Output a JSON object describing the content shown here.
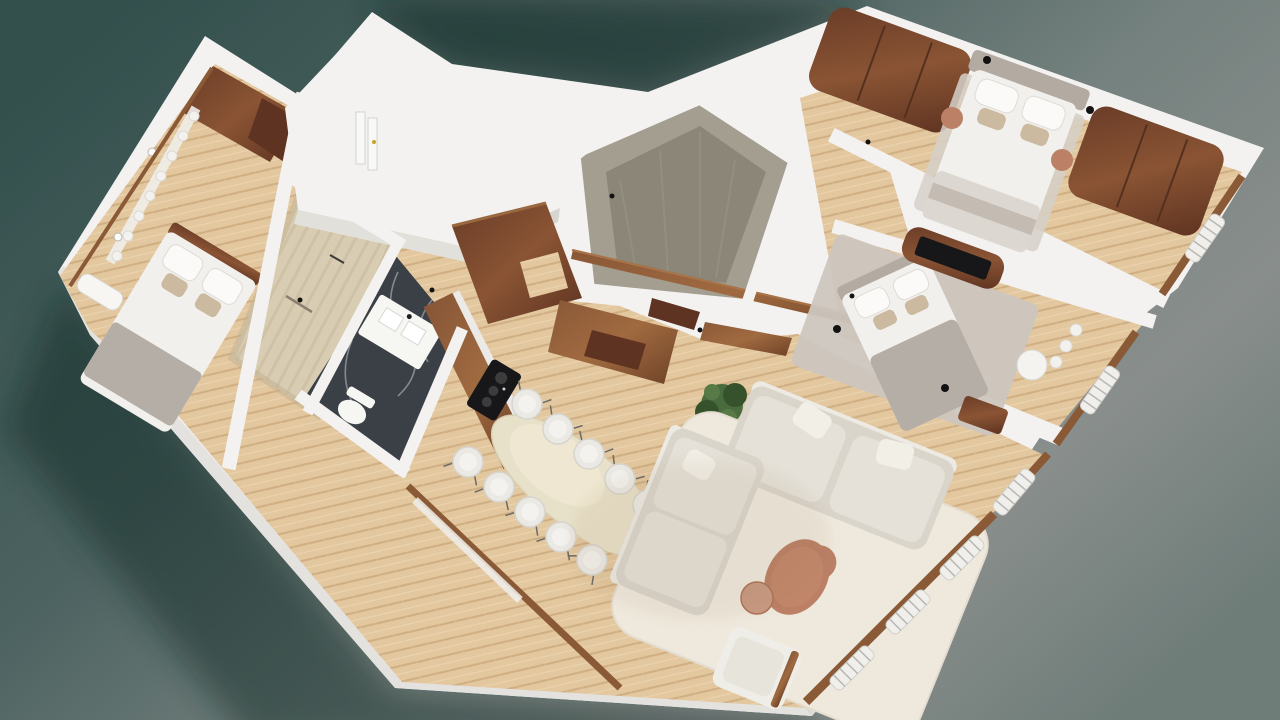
{
  "scene": {
    "type": "3d-floorplan-render",
    "rooms": [
      {
        "id": "guest-bedroom"
      },
      {
        "id": "shower-room"
      },
      {
        "id": "bathroom"
      },
      {
        "id": "storage-core"
      },
      {
        "id": "entry-closet"
      },
      {
        "id": "kitchen"
      },
      {
        "id": "dining-area"
      },
      {
        "id": "living-room"
      },
      {
        "id": "hallway"
      },
      {
        "id": "master-bedroom"
      },
      {
        "id": "second-bedroom"
      }
    ],
    "colors": {
      "bg_teal_dark": "#33504d",
      "bg_teal": "#4c6260",
      "bg_gray_mid": "#74817e",
      "bg_gray": "#898e8c",
      "bg_gray_low": "#6f7d79",
      "shadow": "#102523",
      "wall_white": "#f3f2f0",
      "wall_shade": "#e2e0db",
      "wall_shade2": "#d7d5d0",
      "floor_wood": "#e3c79f",
      "floor_wood_line": "#cfae82",
      "floor_wood_hi": "#f0ddbd",
      "walnut_dark": "#5e3321",
      "walnut": "#8a5434",
      "walnut_mid": "#7a4a2c",
      "walnut_hi": "#a06a40",
      "frame_wood": "#8a5a36",
      "travertine": "#d8ccb2",
      "travertine_dark": "#c2b394",
      "concrete": "#a39e90",
      "concrete_dark": "#8b8677",
      "marble_dark": "#3b4046",
      "marble_vein": "#ccd1d7",
      "linen_white": "#f2f0ec",
      "pillow_pattern": "#cbb9a0",
      "blanket_gray": "#b5aea6",
      "headboard_gray": "#b3aaa1",
      "rug_gray": "#ccc6bf",
      "rug_cream": "#efe9dd",
      "sofa": "#dad5cb",
      "sofa_cushion": "#e5e1d8",
      "table_cream": "#e8e1c9",
      "chair_white": "#ebe9e4",
      "terracotta": "#bb8066",
      "terracotta_light": "#c89a82",
      "plant_green": "#4a6b3d",
      "plant_dark": "#35522c",
      "screen_black": "#17171a",
      "fixture_white": "#f6f6f3",
      "radiator_white": "#f0efec",
      "knob_gold": "#c9a227",
      "dot_black": "#121212"
    }
  }
}
